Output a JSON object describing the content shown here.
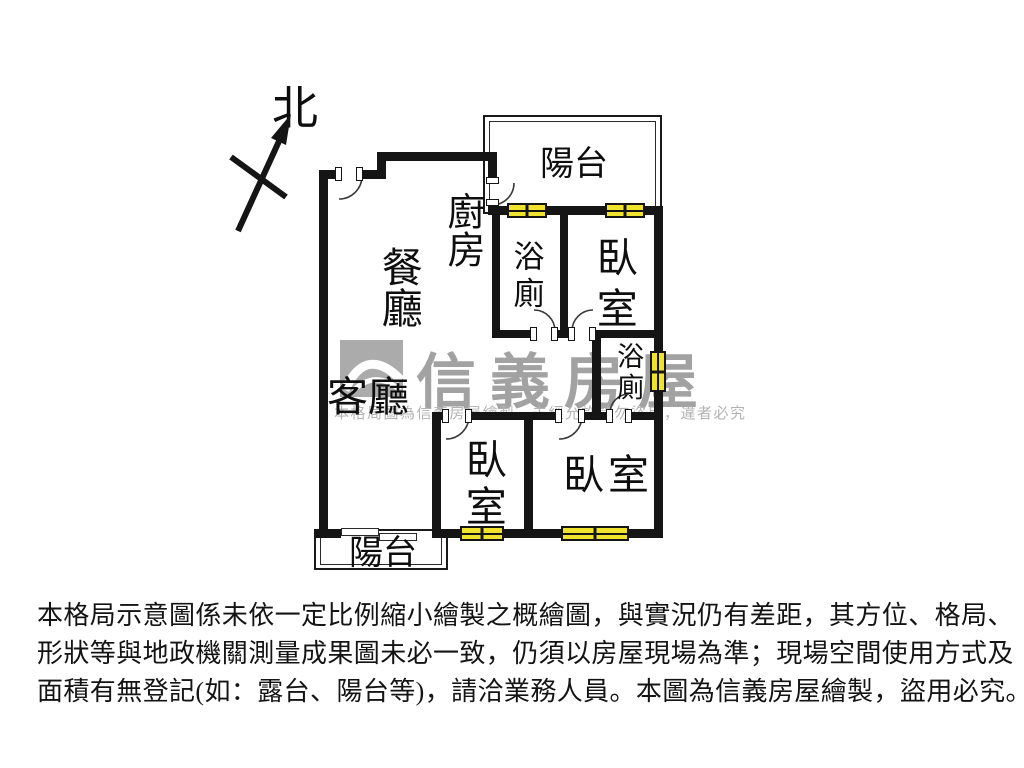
{
  "compass": {
    "label": "北"
  },
  "rooms": {
    "balcony_top": "陽台",
    "kitchen": "廚房",
    "dining": "餐廳",
    "bath_top": "浴廁",
    "bedroom_top_right": "臥室",
    "bath_mid": "浴廁",
    "living": "客廳",
    "bedroom_bottom_left": "臥室",
    "bedroom_bottom_right": "臥室",
    "balcony_bottom": "陽台"
  },
  "watermark": {
    "brand": "信義房屋",
    "notice": "本格局圖為信義房屋繪製，未經允許請勿盜用，違者必究"
  },
  "disclaimer": {
    "lines": [
      "本格局示意圖係未依一定比例縮小繪製之概繪圖，與實況仍有差距，其方位、格局、",
      "形狀等與地政機關測量成果圖未必一致，仍須以房屋現場為準；現場空間使用方式及",
      "面積有無登記(如：露台、陽台等)，請洽業務人員。本圖為信義房屋繪製，盜用必究。"
    ]
  },
  "colors": {
    "wall": "#151515",
    "window_fill": "#efe32e",
    "watermark_gray": "#a8a8a8"
  }
}
